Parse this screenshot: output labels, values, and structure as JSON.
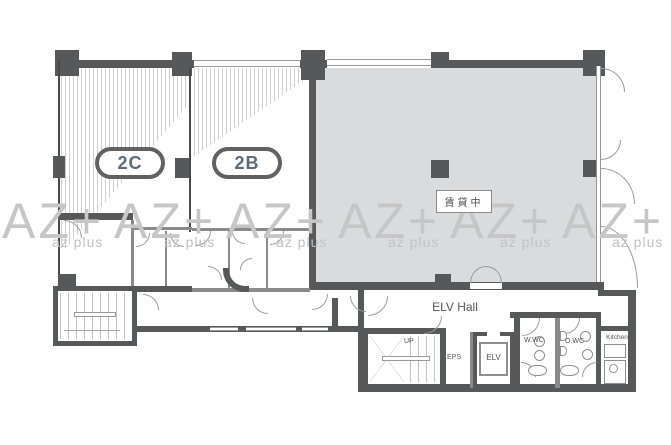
{
  "labels": {
    "unit_2c": "2C",
    "unit_2b": "2B",
    "rented": "賃貸中",
    "elv_hall": "ELV Hall",
    "up": "UP",
    "eps": "EPS",
    "elv": "ELV",
    "wwc": "W.WC",
    "owc": "O.WC",
    "kitchen": "Kitchen"
  },
  "watermark": {
    "big": "AZ+",
    "small": "az plus"
  },
  "colors": {
    "wall": "#57585a",
    "rented_fill": "#dadbdc",
    "watermark": "#c6c6c6",
    "unit_label_text": "#5c6c7a"
  }
}
